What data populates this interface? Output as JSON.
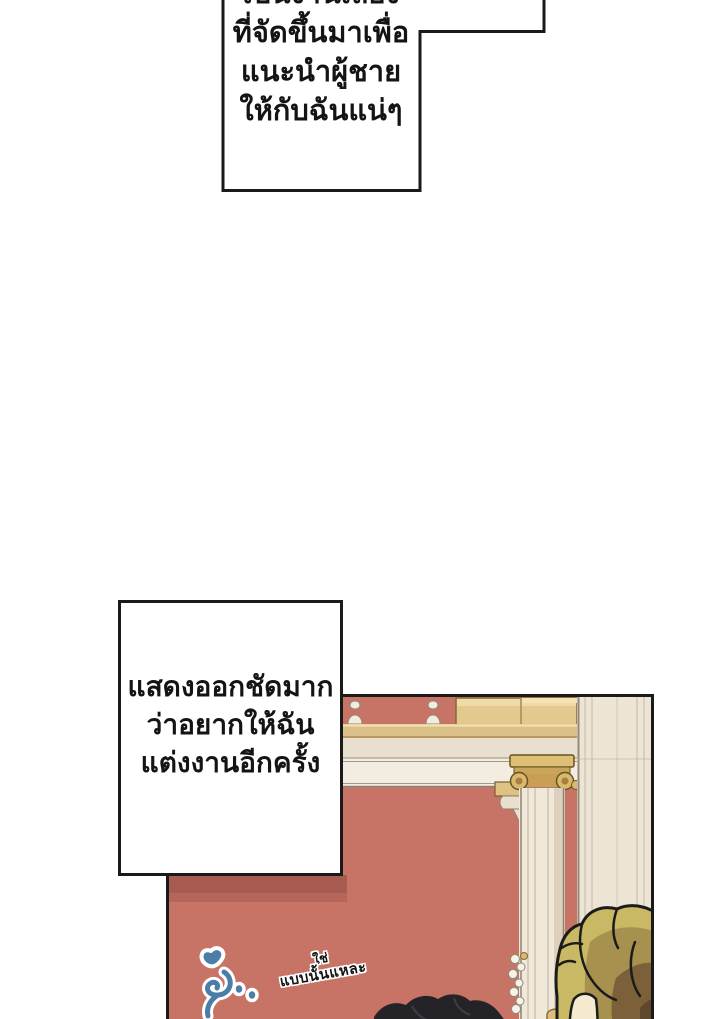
{
  "page": {
    "width": 720,
    "height": 1019,
    "background": "#ffffff",
    "type": "comic page"
  },
  "speech_bubbles": {
    "top": {
      "lines": [
        "เป็นงานเลี้ยง",
        "ที่จัดขึ้นมาเพื่อ",
        "แนะนำผู้ชาย",
        "ให้กับฉันแน่ๆ"
      ]
    },
    "middle": {
      "lines": [
        "แสดงออกชัดมาก",
        "ว่าอยากให้ฉัน",
        "แต่งงานอีกครั้ง"
      ]
    }
  },
  "panel": {
    "handwritten_note": {
      "lines": [
        "ใช่",
        "แบบนั้นแหละ"
      ]
    },
    "sfx": {
      "description": "blue sobbing squiggle with two dots",
      "color": "#4c7da7"
    },
    "scene": {
      "wall_color": "#c77365",
      "wall_shadow_color": "#a85b50",
      "column_color": "#f0e9da",
      "pilaster_color": "#ece4d5",
      "capital_color": "#d9b96d",
      "railing_color": "#dcc089",
      "golden_box_color": "#e4c98e",
      "cornice_color": "#e8dfce",
      "baluster_color": "#f2ecdc",
      "garland_color": "#f6f2e8",
      "black_hair_color": "#242428",
      "blonde_hair_colors": [
        "#c9b964",
        "#a6914e",
        "#7c6039",
        "#5e472b"
      ],
      "skin_color": "#f5ead0",
      "border_color": "#1a1a1a"
    }
  }
}
